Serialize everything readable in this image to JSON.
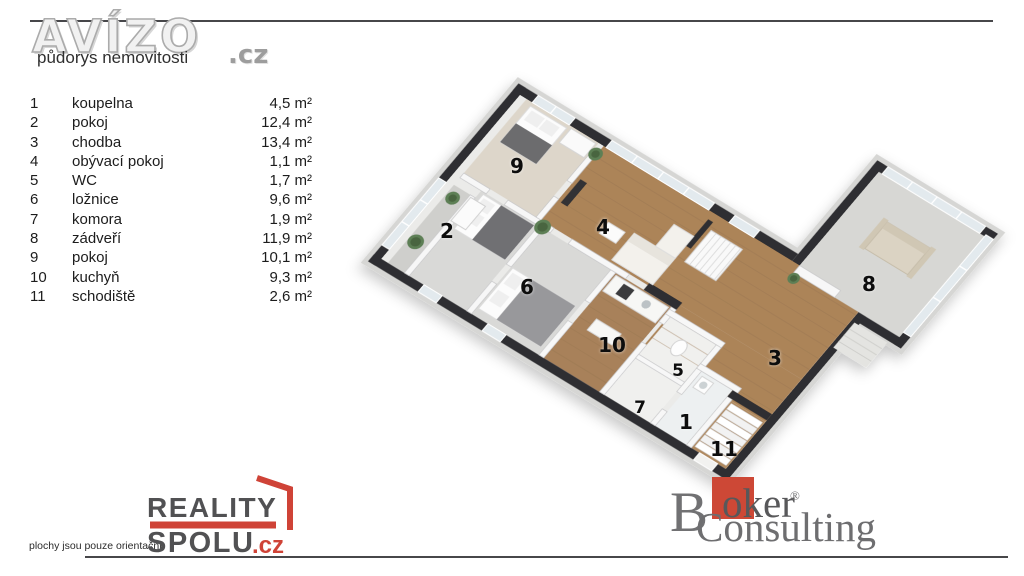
{
  "header": {
    "brand": "AVÍZO",
    "brand_suffix": ".cz",
    "subtitle": "půdorys nemovitosti"
  },
  "legend": {
    "rows": [
      {
        "num": "1",
        "name": "koupelna",
        "area": "4,5 m²"
      },
      {
        "num": "2",
        "name": "pokoj",
        "area": "12,4 m²"
      },
      {
        "num": "3",
        "name": "chodba",
        "area": "13,4 m²"
      },
      {
        "num": "4",
        "name": "obývací pokoj",
        "area": "1,1 m²"
      },
      {
        "num": "5",
        "name": "WC",
        "area": "1,7 m²"
      },
      {
        "num": "6",
        "name": "ložnice",
        "area": "9,6 m²"
      },
      {
        "num": "7",
        "name": "komora",
        "area": "1,9 m²"
      },
      {
        "num": "8",
        "name": "zádveří",
        "area": "11,9 m²"
      },
      {
        "num": "9",
        "name": "pokoj",
        "area": "10,1 m²"
      },
      {
        "num": "10",
        "name": "kuchyň",
        "area": "9,3 m²"
      },
      {
        "num": "11",
        "name": "schodiště",
        "area": "2,6 m²"
      }
    ]
  },
  "footer": {
    "disclaimer": "plochy jsou pouze orientační",
    "reality": {
      "line1": "REALITY",
      "line2": "SPOLU",
      "suffix": ".cz"
    },
    "broker": {
      "initial": "B",
      "part1": "oker",
      "registered": "®",
      "part2": "Consulting"
    }
  },
  "colors": {
    "accent_red": "#cf4337",
    "wall_dark": "#2f2f31",
    "wood_floor": "#ab8459",
    "gray_floor": "#d9d9d7"
  }
}
